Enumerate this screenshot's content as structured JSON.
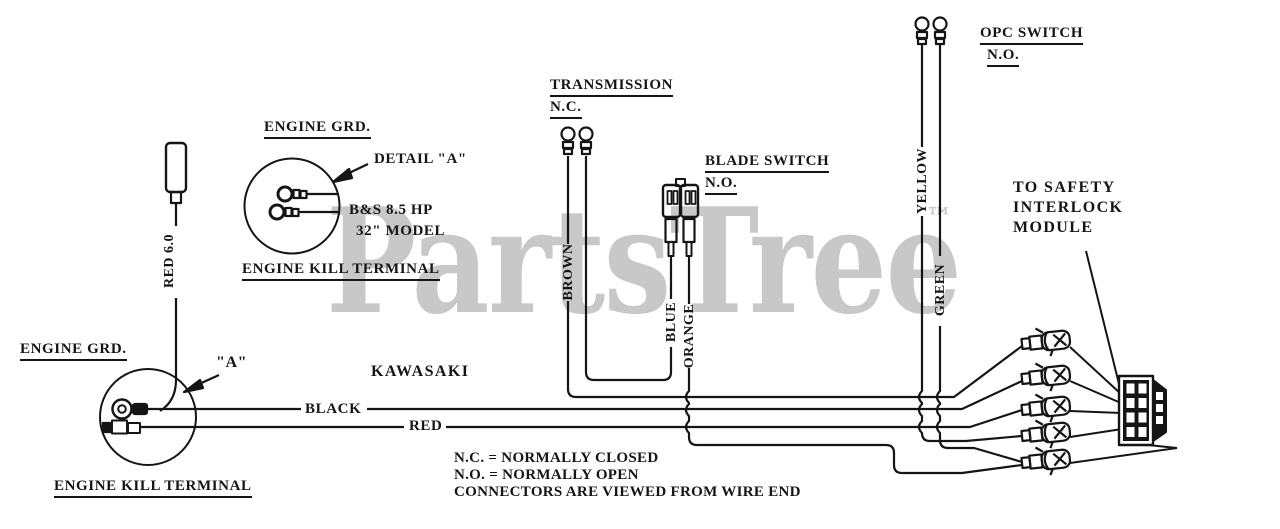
{
  "diagram": {
    "labels": {
      "engine_grd_top": "ENGINE GRD.",
      "detail_a": "DETAIL \"A\"",
      "bs_hp": "B&S 8.5 HP",
      "model": "32\" MODEL",
      "engine_kill_top": "ENGINE KILL TERMINAL",
      "engine_grd_bottom": "ENGINE GRD.",
      "a_callout": "\"A\"",
      "engine_kill_bottom": "ENGINE KILL TERMINAL",
      "transmission": "TRANSMISSION",
      "transmission_state": "N.C.",
      "blade_switch": "BLADE SWITCH",
      "blade_state": "N.O.",
      "opc_switch": "OPC SWITCH",
      "opc_state": "N.O.",
      "safety_line1": "TO SAFETY",
      "safety_line2": "INTERLOCK",
      "safety_line3": "MODULE",
      "kawasaki": "KAWASAKI",
      "black": "BLACK",
      "red": "RED"
    },
    "wire_labels": {
      "red60": "RED 6.0",
      "brown": "BROWN",
      "blue": "BLUE",
      "orange": "ORANGE",
      "yellow": "YELLOW",
      "green": "GREEN"
    },
    "notes": [
      "N.C. = NORMALLY CLOSED",
      "N.O. = NORMALLY OPEN",
      "CONNECTORS ARE VIEWED FROM WIRE END"
    ],
    "watermark": {
      "text": "PartsTree",
      "tm": "™",
      "color": "#c8c8c8"
    },
    "ink": "#151515"
  }
}
